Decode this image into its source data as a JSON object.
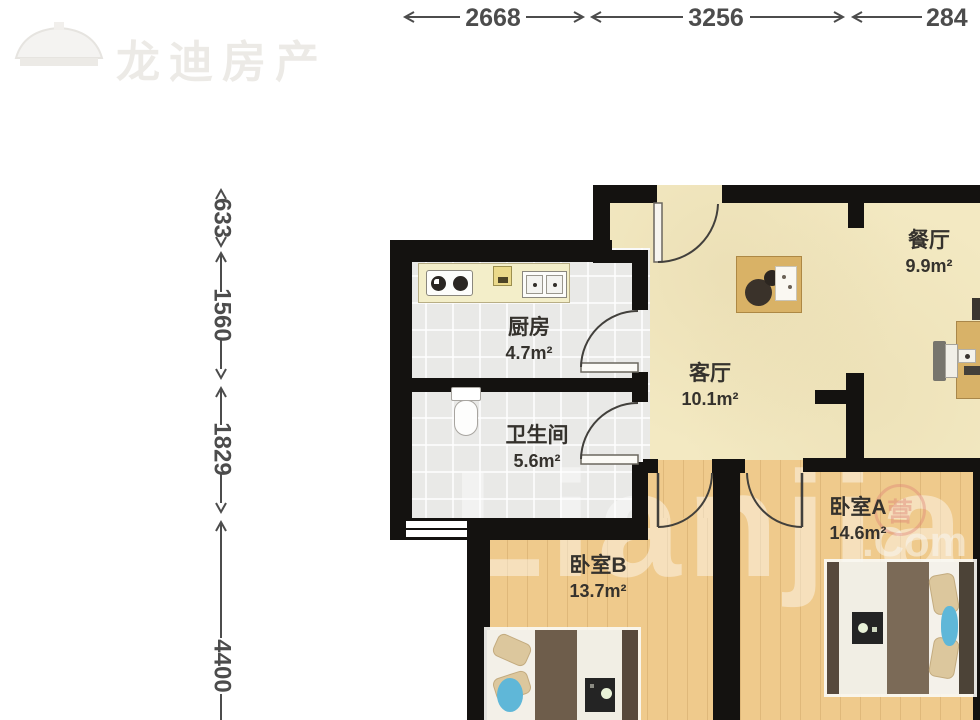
{
  "brand": {
    "name": "龙迪房产"
  },
  "watermark": {
    "site_big": "Lianjia",
    "site_small": ".Com",
    "seal_char": "营"
  },
  "dimensions": {
    "top": [
      "2668",
      "3256",
      "284"
    ],
    "left": [
      "633",
      "1560",
      "1829",
      "4400"
    ]
  },
  "rooms": {
    "kitchen": {
      "name": "厨房",
      "area": "4.7m²"
    },
    "bathroom": {
      "name": "卫生间",
      "area": "5.6m²"
    },
    "living": {
      "name": "客厅",
      "area": "10.1m²"
    },
    "dining": {
      "name": "餐厅",
      "area": "9.9m²"
    },
    "bedroomA": {
      "name": "卧室A",
      "area": "14.6m²"
    },
    "bedroomB": {
      "name": "卧室B",
      "area": "13.7m²"
    }
  },
  "colors": {
    "wall": "#141210",
    "floor_main": "#f3e9c2",
    "floor_tile": "#e9e9e7",
    "floor_wood": "#efca8c",
    "accent_blue": "#5fb7d8",
    "dimension_text": "#4c4c4c"
  }
}
